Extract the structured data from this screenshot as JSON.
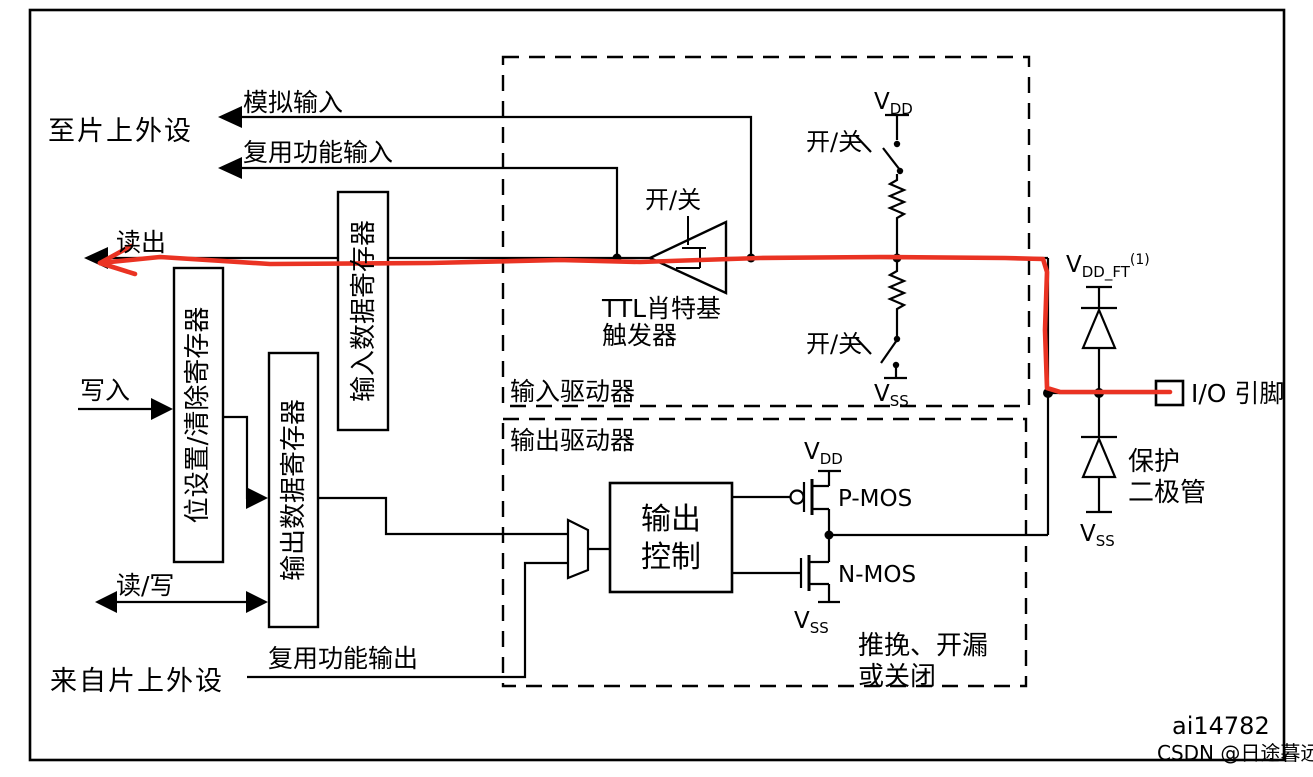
{
  "labels": {
    "to_onchip_peripherals": "至片上外设",
    "analog_input": "模拟输入",
    "alternate_function_input": "复用功能输入",
    "read": "读出",
    "write": "写入",
    "read_write": "读/写",
    "from_onchip_peripherals": "来自片上外设",
    "alternate_function_output": "复用功能输出"
  },
  "registers": {
    "bit_set_clear": "位设置/清除寄存器",
    "output_data": "输出数据寄存器",
    "input_data": "输入数据寄存器"
  },
  "input_driver": {
    "box_label": "输入驱动器",
    "schmitt_onoff": "开/关",
    "schmitt_name_line1": "TTL肖特基",
    "schmitt_name_line2": "触发器",
    "pullup_onoff": "开/关",
    "pulldown_onoff": "开/关",
    "vdd_base": "V",
    "vdd_sub": "DD",
    "vss_base": "V",
    "vss_sub": "SS"
  },
  "output_driver": {
    "box_label": "输出驱动器",
    "control_line1": "输出",
    "control_line2": "控制",
    "pmos": "P-MOS",
    "nmos": "N-MOS",
    "vdd_base": "V",
    "vdd_sub": "DD",
    "vss_base": "V",
    "vss_sub": "SS",
    "mode_line1": "推挽、开漏",
    "mode_line2": "或关闭"
  },
  "pad_section": {
    "vddft_base": "V",
    "vddft_sub": "DD_FT",
    "vddft_sup": "(1)",
    "io_pin": "I/O 引脚",
    "protection_line1": "保护",
    "protection_line2": "二极管",
    "vss_base": "V",
    "vss_sub": "SS"
  },
  "footer": {
    "figure_id": "ai14782",
    "watermark": "CSDN @日途暮远"
  },
  "colors": {
    "line": "#000000",
    "highlight_path": "#ea3323",
    "watermark": "#b9b9b9",
    "background": "#ffffff"
  }
}
